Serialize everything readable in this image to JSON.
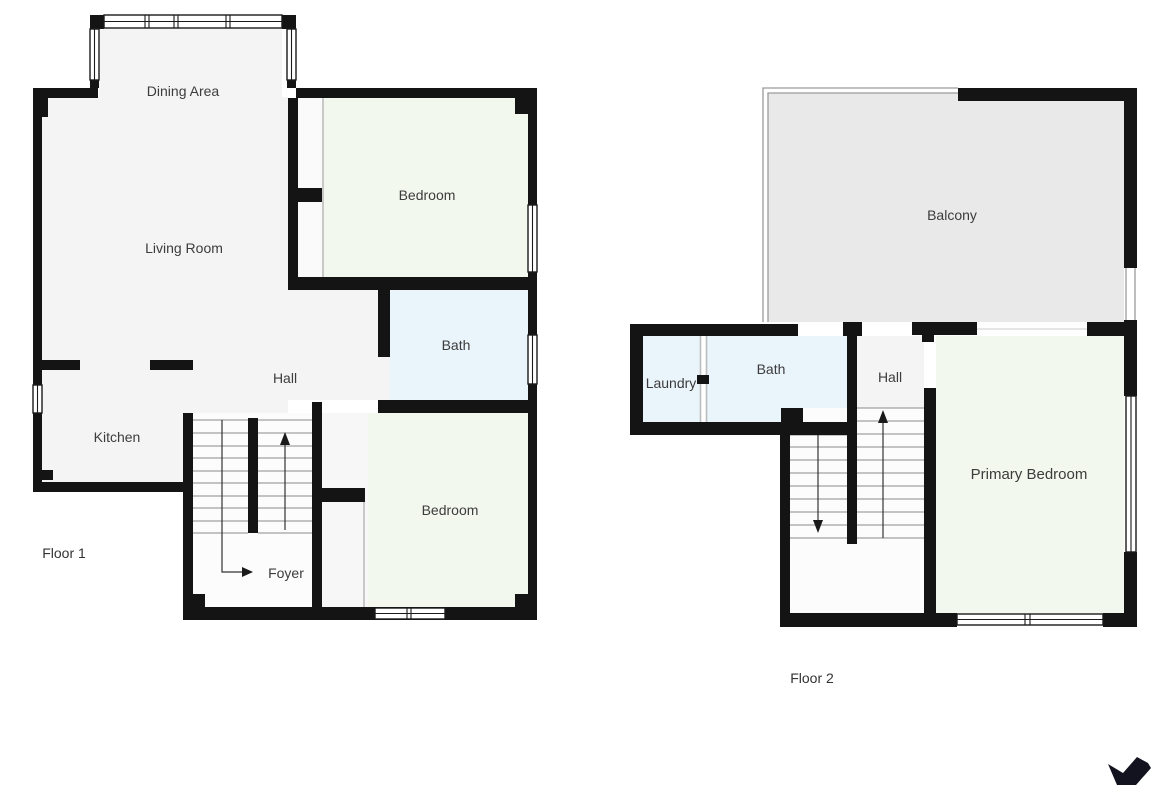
{
  "floor1": {
    "name": "Floor 1",
    "rooms": {
      "dining": "Dining Area",
      "living": "Living Room",
      "bedroom_upper": "Bedroom",
      "bath": "Bath",
      "hall": "Hall",
      "kitchen": "Kitchen",
      "bedroom_lower": "Bedroom",
      "foyer": "Foyer"
    }
  },
  "floor2": {
    "name": "Floor 2",
    "rooms": {
      "balcony": "Balcony",
      "laundry": "Laundry",
      "bath": "Bath",
      "hall": "Hall",
      "primary_bedroom": "Primary Bedroom"
    }
  },
  "colors": {
    "wall": "#141414",
    "room_default": "#f4f4f4",
    "bedroom": "#f3f8ee",
    "bath": "#eaf4fb",
    "balcony": "#e9e9e9",
    "stairs": "#fcfcfc",
    "closet": "#fafafa",
    "label_text": "#3c3c3c",
    "logo": "#13131f"
  },
  "icons": {
    "logo": "bird-logo"
  }
}
